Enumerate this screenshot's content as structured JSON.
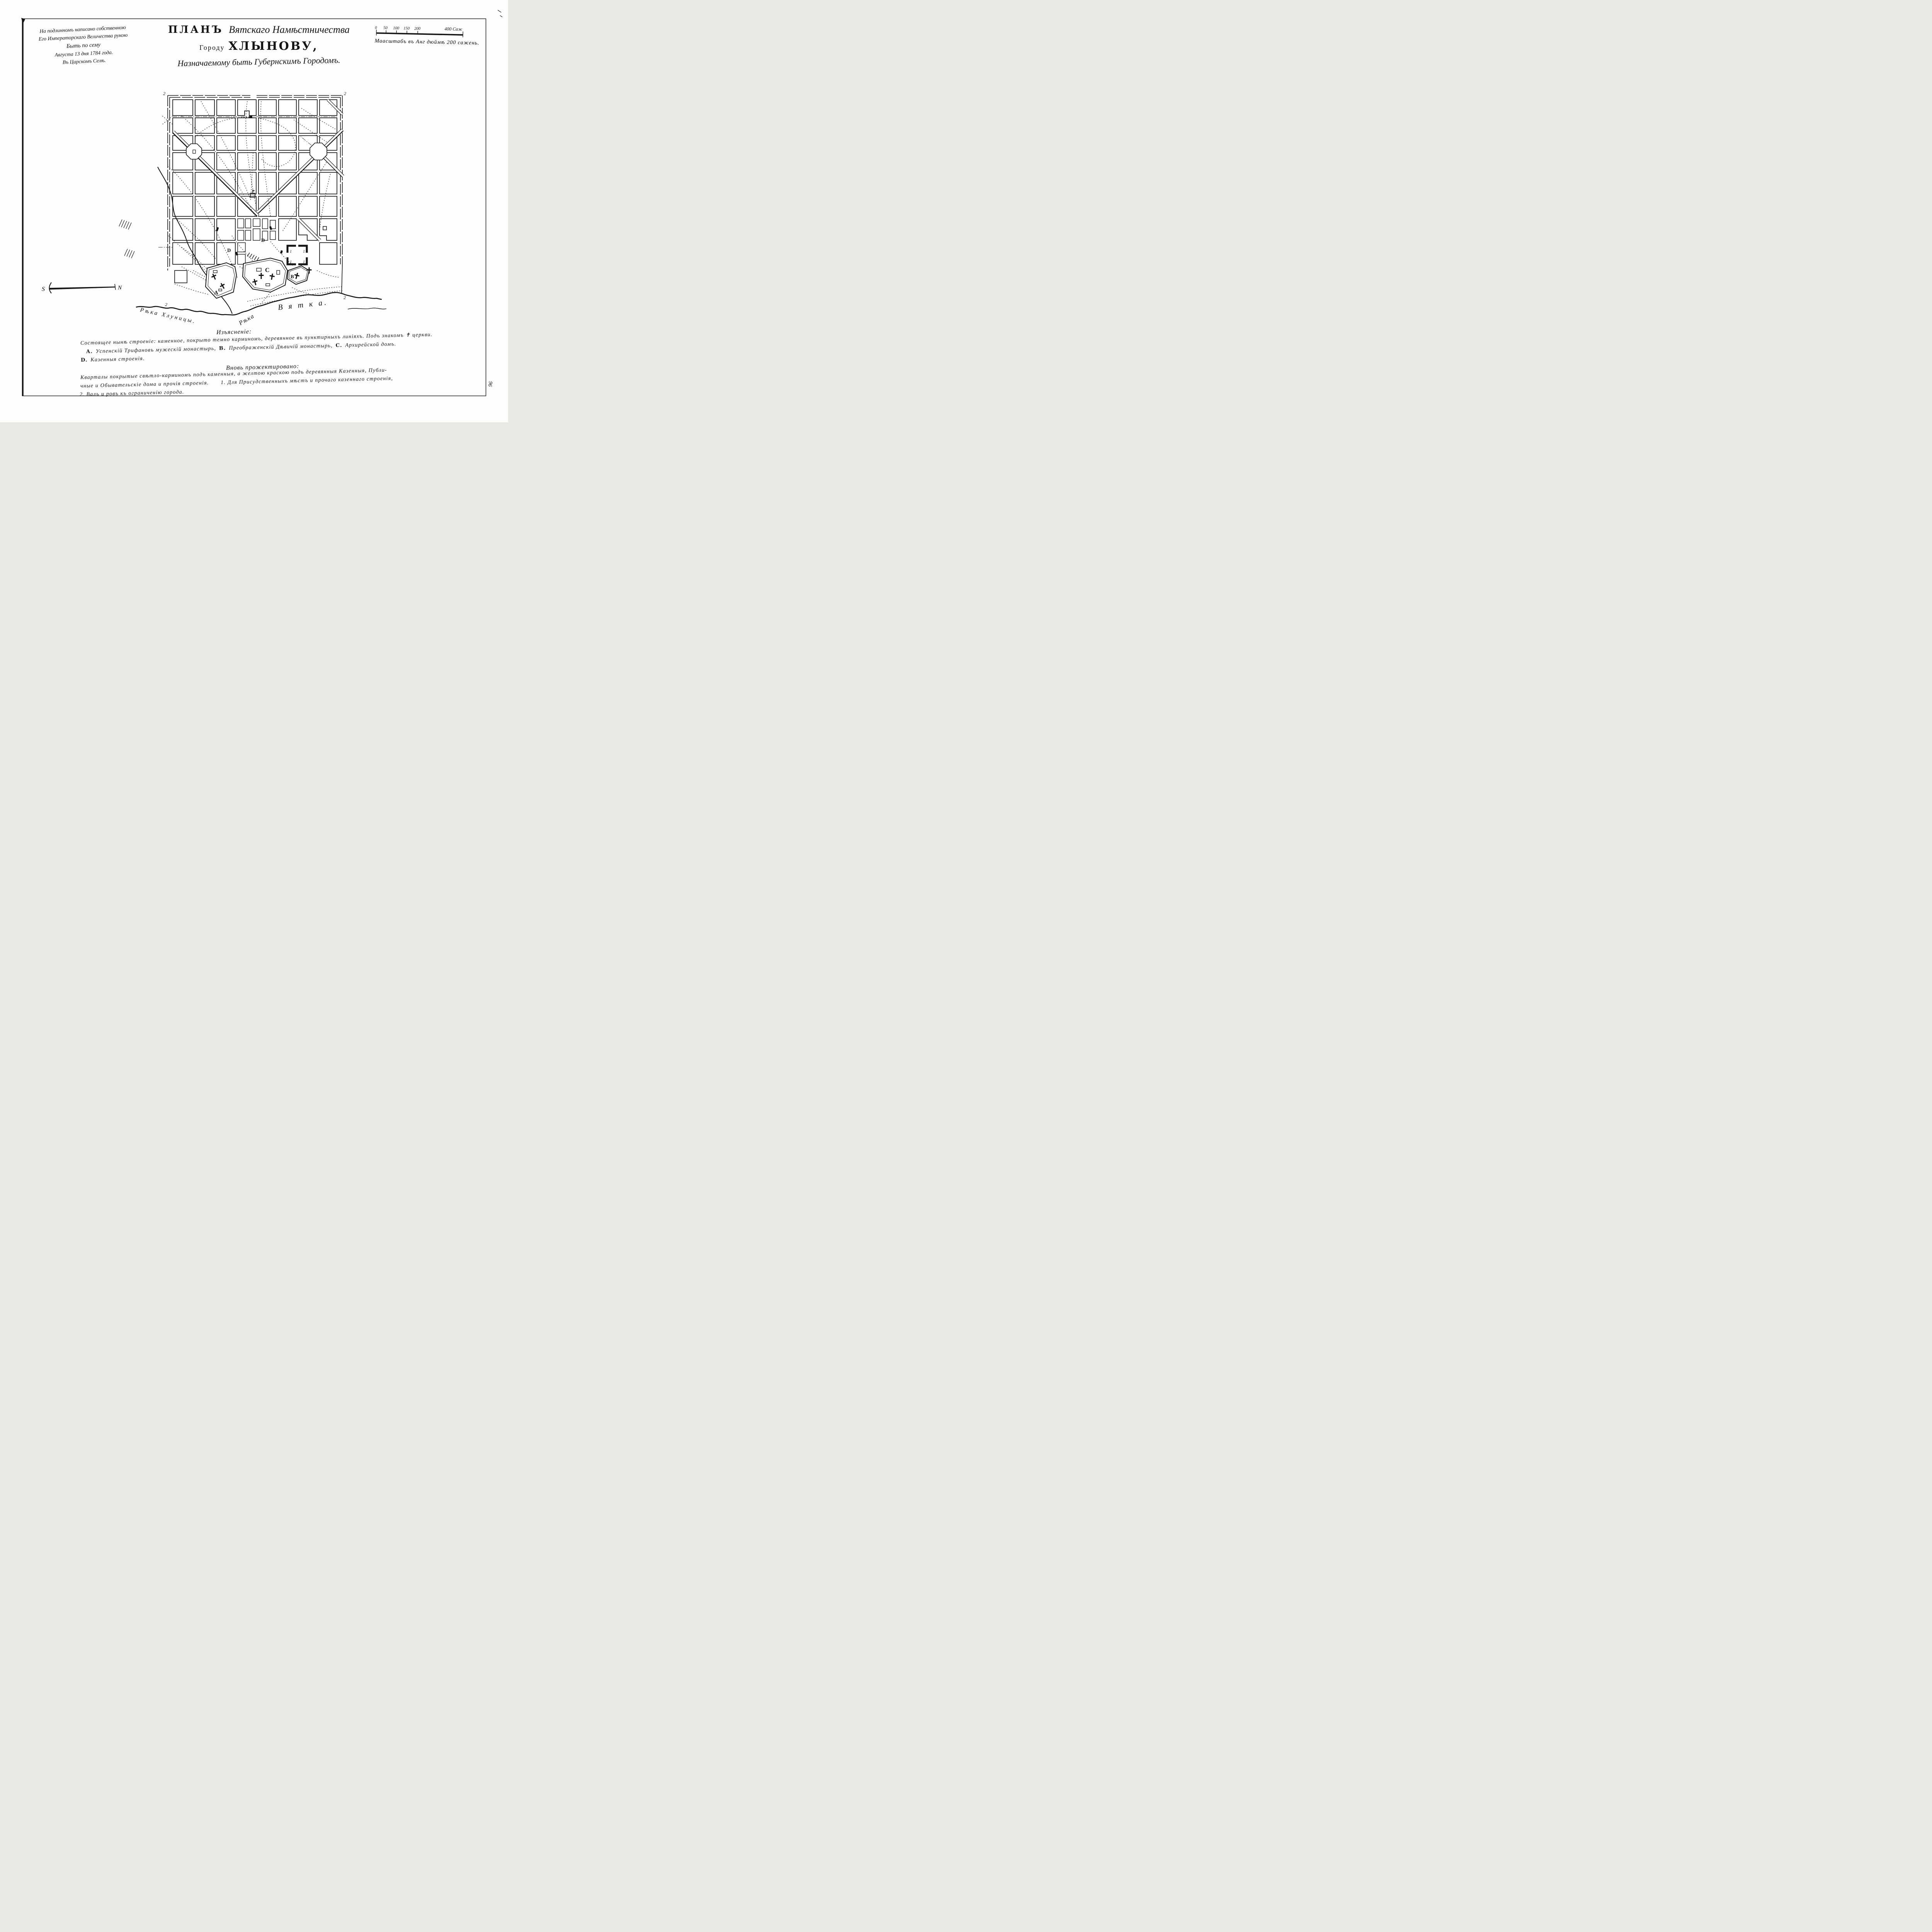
{
  "page": {
    "margin_mark": "96"
  },
  "imperial_note": {
    "lines": [
      "На подлинномъ написано собственною",
      "Его Императорскаго Величества рукою",
      "Быть по сему",
      "Августа 13 дня 1784 года.",
      "Въ Царскомъ Селѣ."
    ]
  },
  "title": {
    "plan_word": "ПЛАНЪ",
    "script_line": "Вятскаго Намѣстничества",
    "city_prefix": "Городу",
    "city_name": "ХЛЫНОВУ,",
    "subtitle": "Назначаемому быть Губернскимъ Городомъ."
  },
  "scale_bar": {
    "tick_0": "0",
    "tick_50": "50",
    "tick_100": "100",
    "tick_150": "150",
    "tick_200": "200",
    "end_label": "400 Саж",
    "caption": "Маасштабъ въ Анг дюймѣ 200 сажень."
  },
  "compass": {
    "south": "S",
    "north": "N"
  },
  "map": {
    "rampart_label": "2",
    "labels": {
      "a": "A",
      "b": "B",
      "c": "C",
      "d": "D",
      "gov": "1"
    },
    "rivers": {
      "left": "Рѣка Хлуницы.",
      "right_prefix": "Рѣка",
      "right_name": "В я т к а."
    }
  },
  "legend": {
    "heading_existing": "Изъясненіе:",
    "existing_line1": "Состоящее нынѣ строеніе: каменное, покрыто темно карминомъ, деревянное въ пунктирныхъ линіяхъ. Подъ знакомъ ✝ церкви.",
    "item_a_letter": "A.",
    "item_a": "Успенскій Трифановъ мужескій монастырь,",
    "item_b_letter": "B.",
    "item_b": "Преображенскій Дѣвичій монастырь,",
    "item_c_letter": "C.",
    "item_c": "Архирейской домъ.",
    "item_d_letter": "D.",
    "item_d": "Казенныя строенія.",
    "heading_projected": "Вновь прожектировано:",
    "projected_line1": "Кварталы покрытые свѣтло-карминомъ подъ каменныя, а желтою краскою подъ деревянныя Казенныя, Публи-",
    "projected_line2": "чные и Обывательскіе дома и прочія строенія.",
    "projected_item1_num": "1.",
    "projected_item1": "Для Присудственныхъ мѣстъ и прочаго казеннаго строенія,",
    "projected_item2_num": "2.",
    "projected_item2": "Валъ и ровъ къ ограниченію города."
  }
}
